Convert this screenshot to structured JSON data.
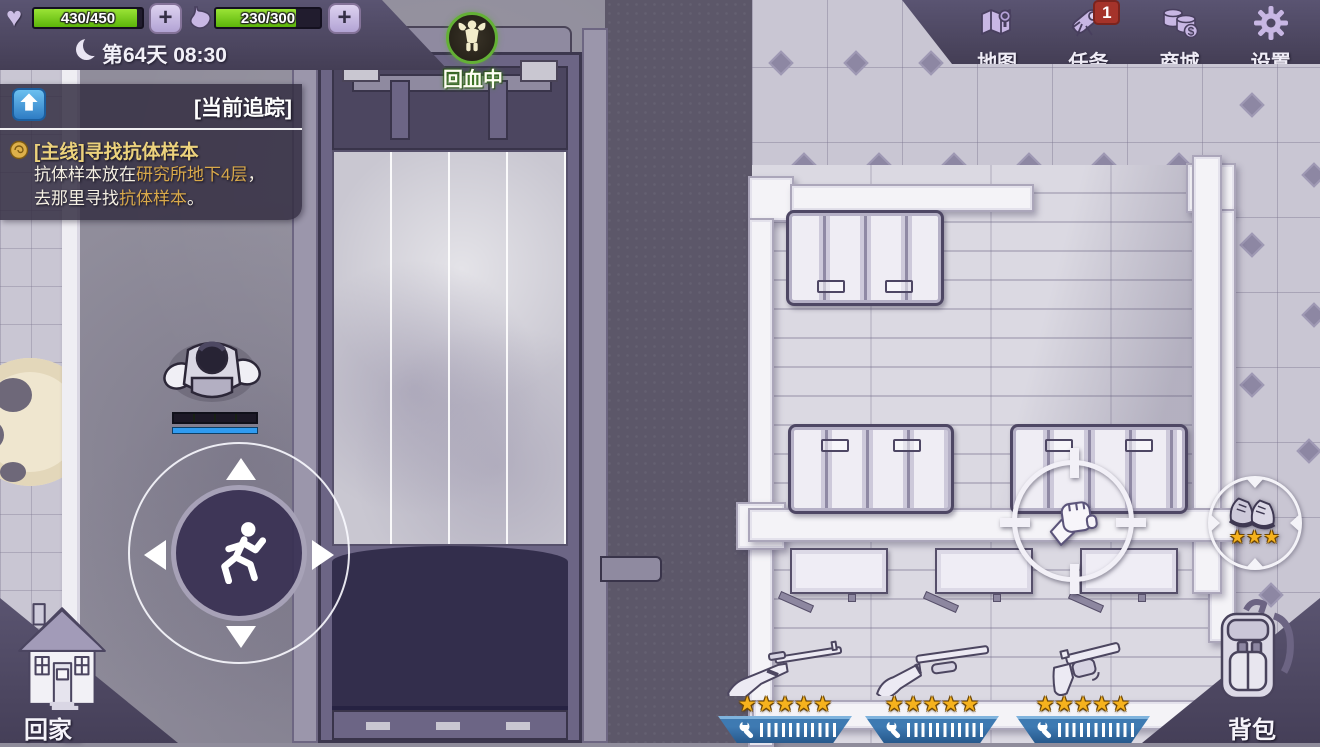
{
  "hud": {
    "health": {
      "value": "430/450",
      "percent": 95.5
    },
    "satiety": {
      "value": "230/300",
      "percent": 76.7
    },
    "day_time": "第64天 08:30",
    "buff_label": "回血中"
  },
  "top_menu": {
    "map": "地图",
    "tasks": "任务",
    "tasks_badge": "1",
    "shop": "商城",
    "settings": "设置"
  },
  "quest_tracker": {
    "header": "[当前追踪]",
    "title": "[主线]寻找抗体样本",
    "body_1": "抗体样本放在",
    "body_1_hl": "研究所地下4层",
    "body_1_tail": "，",
    "body_2": "去那里寻找",
    "body_2_hl": "抗体样本",
    "body_2_tail": "。"
  },
  "corner_buttons": {
    "home": "回家",
    "backpack": "背包"
  },
  "weapons": [
    {
      "name": "rifle",
      "stars": "★★★★★"
    },
    {
      "name": "shotgun",
      "stars": "★★★★★"
    },
    {
      "name": "revolver",
      "stars": "★★★★★"
    }
  ],
  "pickup": {
    "name": "boots",
    "stars": "★★★"
  },
  "colors": {
    "health_green": "#6fc913",
    "hud_purple": "#554e6b",
    "badge_red": "#a5332a",
    "star_gold": "#f6b21d",
    "durability_blue": "#2e6ba3",
    "quest_gold": "#ecd27c",
    "quest_highlight": "#d9a94a",
    "buff_green": "#63b135"
  }
}
